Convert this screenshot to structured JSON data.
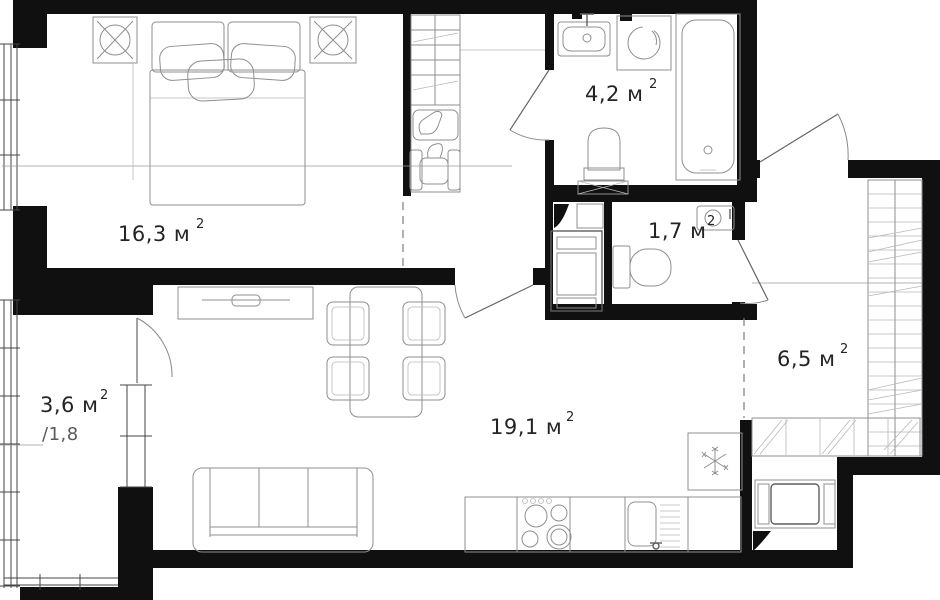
{
  "rooms": [
    {
      "name": "bedroom",
      "area": "16,3 м",
      "sup": "2"
    },
    {
      "name": "bathroom",
      "area": "4,2 м",
      "sup": "2"
    },
    {
      "name": "wc",
      "area": "1,7 м",
      "sup": "2"
    },
    {
      "name": "hallway",
      "area": "6,5 м",
      "sup": "2"
    },
    {
      "name": "living-kitchen",
      "area": "19,1 м",
      "sup": "2"
    },
    {
      "name": "balcony",
      "area": "3,6 м",
      "sup": "2",
      "coefficient": "/1,8"
    }
  ],
  "colors": {
    "wall": "#101010",
    "furniture_line": "#8f8f8f",
    "label": "#242424"
  }
}
